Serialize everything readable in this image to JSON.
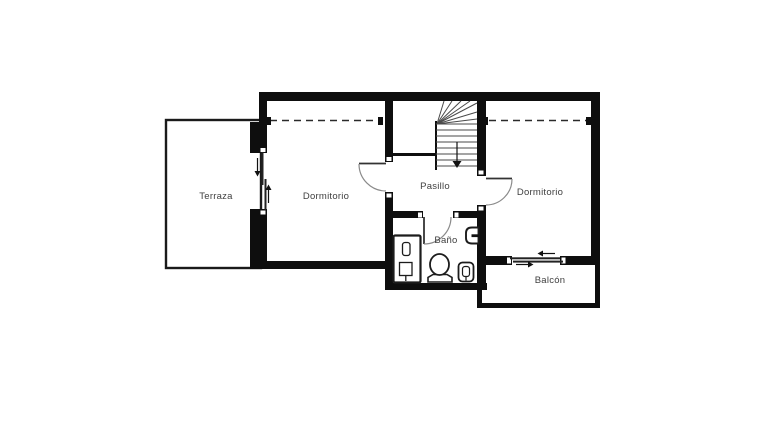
{
  "plan": {
    "type": "floor-plan",
    "background_color": "#ffffff",
    "wall_color": "#0e0e0e",
    "label_color": "#3f3f3f",
    "rooms": [
      {
        "name": "terraza",
        "label": "Terraza"
      },
      {
        "name": "dormitorio-left",
        "label": "Dormitorio"
      },
      {
        "name": "pasillo",
        "label": "Pasillo"
      },
      {
        "name": "dormitorio-right",
        "label": "Dormitorio"
      },
      {
        "name": "bano",
        "label": "Baño"
      },
      {
        "name": "balcon",
        "label": "Balcón"
      }
    ],
    "features": {
      "stairs": "stairs-with-winders-and-down-arrow",
      "sliding_doors": [
        "terraza-sliding-door",
        "balcon-sliding-door"
      ],
      "swing_doors": [
        "dormitorio-left-door",
        "dormitorio-right-door",
        "bano-door"
      ],
      "bath_fixtures": [
        "shower",
        "toilet",
        "bidet",
        "sink"
      ],
      "closet_dashed_lines": [
        "dormitorio-left",
        "dormitorio-right"
      ]
    }
  }
}
